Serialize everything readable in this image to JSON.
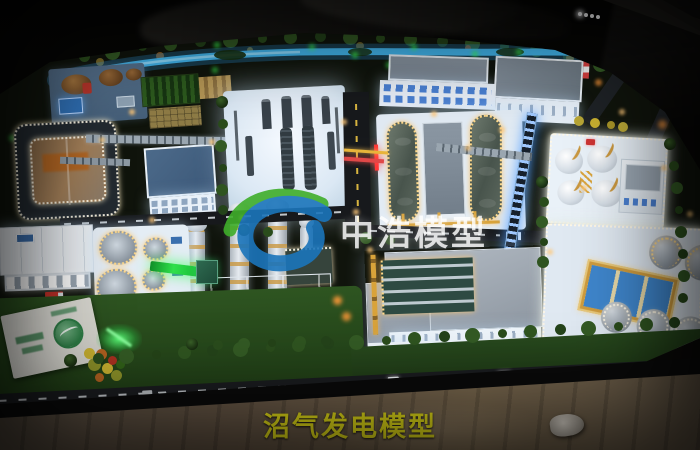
{
  "watermark": {
    "text": "中浩模型",
    "logo": "green-blue-swirl-logo",
    "text_color": "#ffffff",
    "logo_green": "#3fae2a",
    "logo_blue": "#1b75bb"
  },
  "caption": {
    "text": "沼气发电模型",
    "color": "#e6df18"
  },
  "palette": {
    "room_background": "#070706",
    "river_glow_blue": "#3ab4f2",
    "tree_led_green": "#3bff4e",
    "warm_led": "#ffc878",
    "led_white": "#fff6e4",
    "led_gold": "#ffd98a",
    "lawn_green": "#2e5521",
    "platform_white": "#eaf2fa",
    "roof_grey": "#9aa4b0",
    "roof_blue_grey": "#4a6a8c",
    "tank_grey": "#8a949e",
    "digester_dark": "#49544c",
    "pipe_gold": "#d9a33a",
    "pipe_red": "#e04848",
    "conveyor_green": "#2fe04a",
    "conveyor_blue": "#4a9aff",
    "lagoon_brown": "#9a7652",
    "table_wood": "#6a5a46",
    "window_blue": "#4a80d2"
  }
}
